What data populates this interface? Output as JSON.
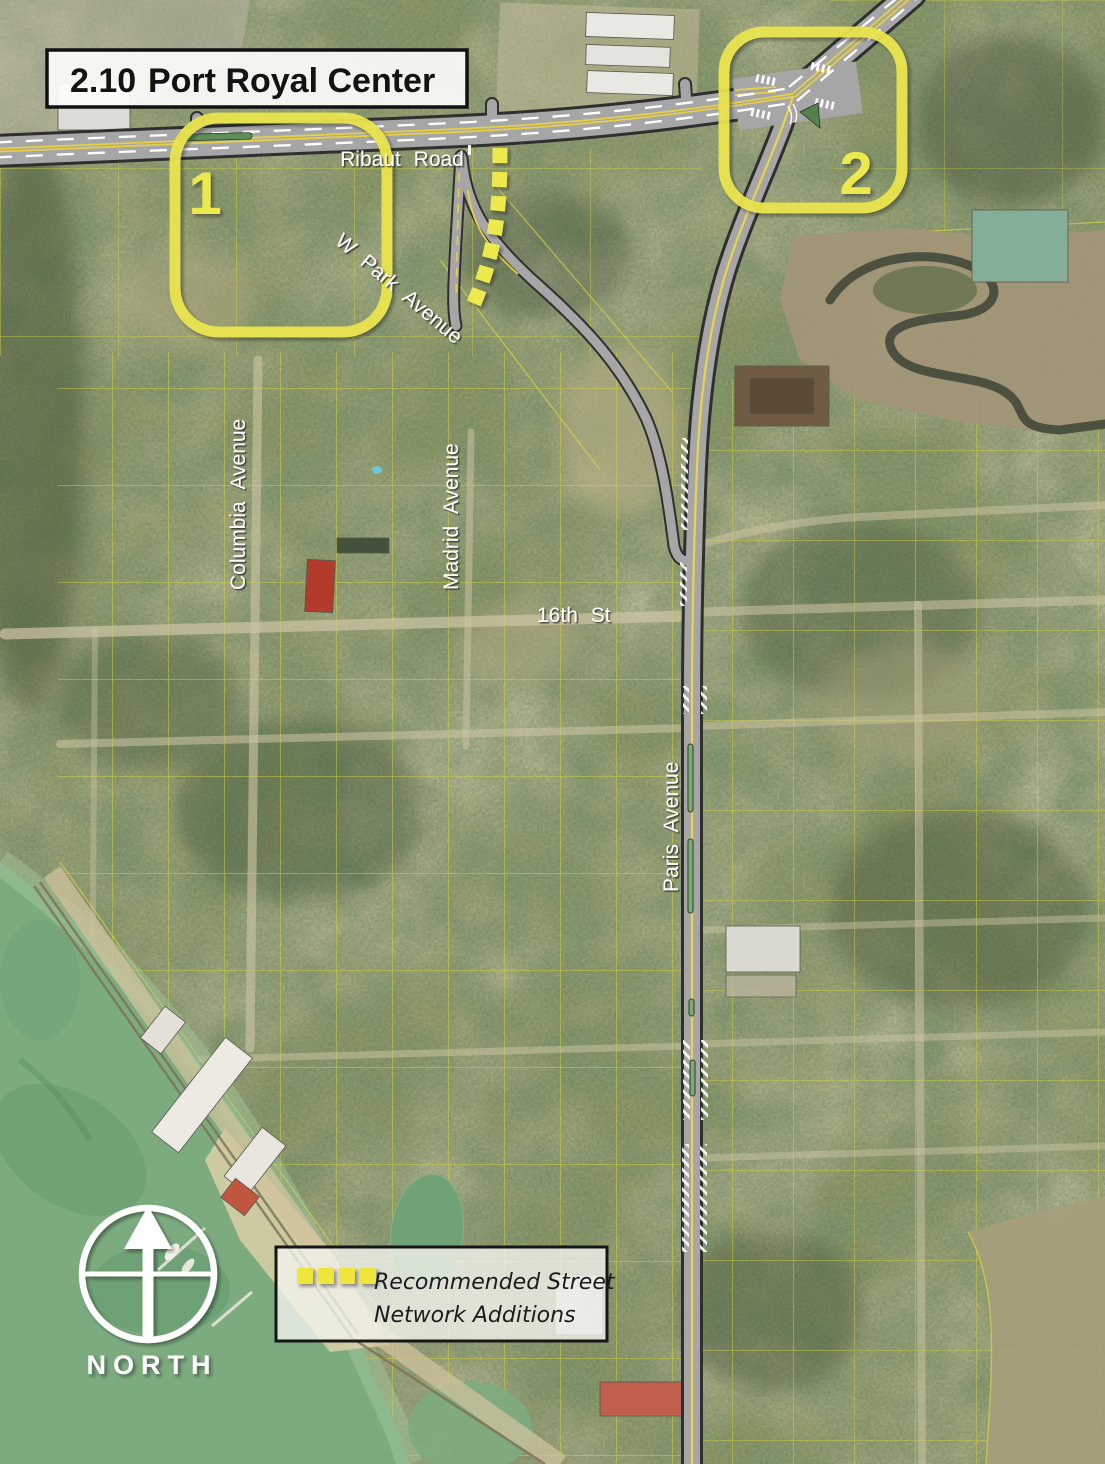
{
  "title": {
    "number": "2.10",
    "name": "Port Royal Center"
  },
  "streets": {
    "ribaut": "Ribaut Road",
    "w_park": "W Park Avenue",
    "columbia": "Columbia Avenue",
    "madrid": "Madrid Avenue",
    "sixteenth": "16th St",
    "paris": "Paris Avenue"
  },
  "callouts": [
    {
      "number": "1"
    },
    {
      "number": "2"
    }
  ],
  "legend": {
    "lines": [
      "Recommended Street",
      "Network Additions"
    ],
    "swatch": "yellow-dash-icon"
  },
  "compass": {
    "label": "NORTH"
  },
  "colors": {
    "highlight_yellow": "#e9e44e",
    "parcel_line_yellow": "#d6d240",
    "road_gray": "#a6a6a6",
    "road_casing": "#2f2f2f",
    "lane_yellow": "#e6cf45",
    "median_green": "#7cac70",
    "water_green": "#7dab80",
    "marsh_tan": "#a39577"
  }
}
